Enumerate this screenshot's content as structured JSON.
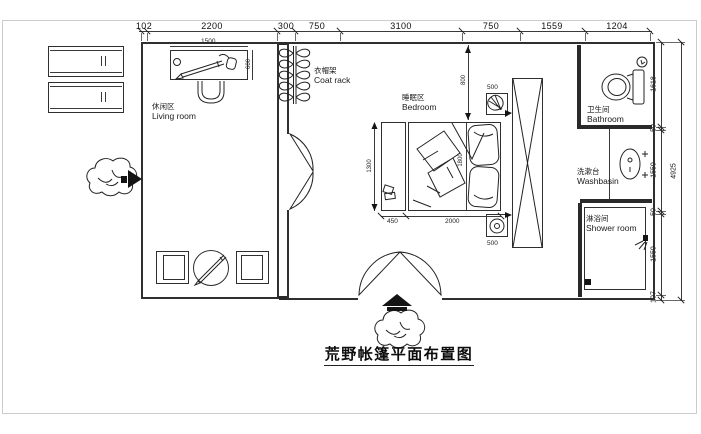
{
  "frame": {
    "title": "荒野帐篷平面布置图"
  },
  "dims": {
    "top": [
      "102",
      "2200",
      "300",
      "750",
      "3100",
      "750",
      "1559",
      "1204"
    ],
    "right": [
      "1618",
      "50",
      "1550",
      "50",
      "1550",
      "107"
    ],
    "right_total": "4925",
    "desk_width": "1500",
    "desk_depth": "600",
    "bench_height": "1300",
    "bench_width": "450",
    "bed_width": "2000",
    "bed_length": "1800",
    "bed_offset": "800",
    "nightstand_top": "500",
    "nightstand_bottom": "500"
  },
  "rooms": {
    "living": {
      "zh": "休闲区",
      "en": "Living room"
    },
    "bedroom": {
      "zh": "睡眠区",
      "en": "Bedroom"
    },
    "coat_rack": {
      "zh": "衣帽架",
      "en": "Coat rack"
    },
    "bathroom": {
      "zh": "卫生间",
      "en": "Bathroom"
    },
    "washbasin": {
      "zh": "洗漱台",
      "en": "Washbasin"
    },
    "shower": {
      "zh": "淋浴间",
      "en": "Shower room"
    }
  },
  "colors": {
    "line": "#232323",
    "wall": "#2a2a2a",
    "dim_text": "#101010",
    "frame_border": "#cccccc",
    "background": "#ffffff"
  }
}
